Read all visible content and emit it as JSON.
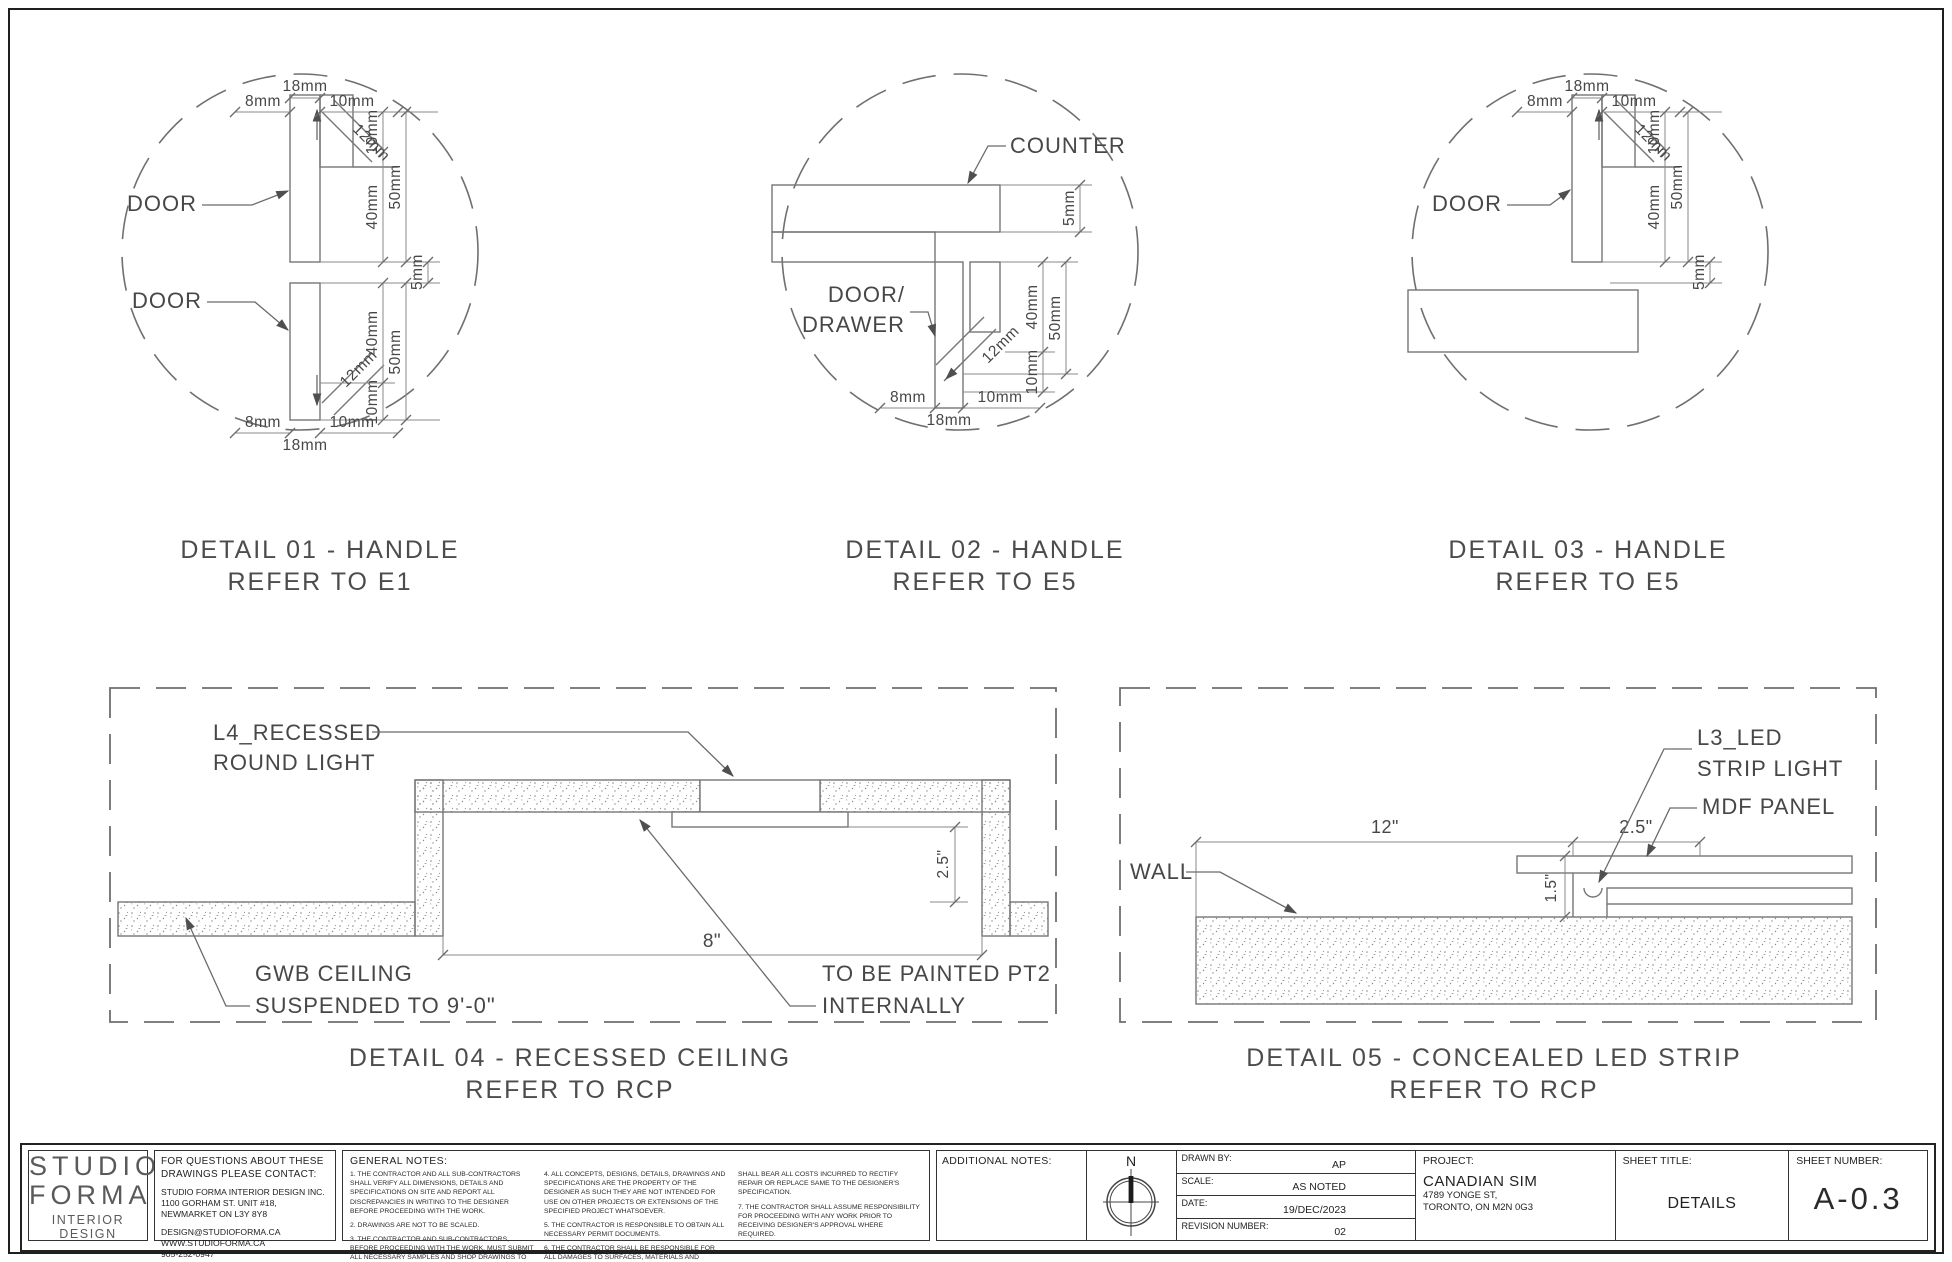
{
  "details": {
    "d01": {
      "title": "DETAIL 01 - HANDLE",
      "subtitle": "REFER TO E1",
      "labels": {
        "door_top": "DOOR",
        "door_bottom": "DOOR"
      },
      "dims": {
        "top": [
          "8mm",
          "18mm",
          "10mm"
        ],
        "bottom": [
          "8mm",
          "18mm",
          "10mm"
        ],
        "diag_top": "12mm",
        "diag_bottom": "12mm",
        "stack_top": [
          "10mm",
          "40mm",
          "50mm",
          "5mm"
        ],
        "stack_bottom": [
          "40mm",
          "50mm",
          "10mm"
        ]
      }
    },
    "d02": {
      "title": "DETAIL 02 - HANDLE",
      "subtitle": "REFER TO E5",
      "labels": {
        "counter": "COUNTER",
        "door_line1": "DOOR/",
        "door_line2": "DRAWER"
      },
      "dims": {
        "bottom": [
          "8mm",
          "18mm",
          "10mm"
        ],
        "diag": "12mm",
        "right": [
          "5mm",
          "40mm",
          "50mm",
          "10mm"
        ]
      }
    },
    "d03": {
      "title": "DETAIL 03 - HANDLE",
      "subtitle": "REFER TO E5",
      "labels": {
        "door": "DOOR"
      },
      "dims": {
        "top": [
          "8mm",
          "18mm",
          "10mm"
        ],
        "diag": "12mm",
        "stack": [
          "10mm",
          "40mm",
          "50mm",
          "5mm"
        ]
      }
    },
    "d04": {
      "title": "DETAIL 04 - RECESSED CEILING",
      "subtitle": "REFER TO RCP",
      "labels": {
        "light_1": "L4_RECESSED",
        "light_2": "ROUND LIGHT",
        "gwb_1": "GWB CEILING",
        "gwb_2": "SUSPENDED TO 9'-0\"",
        "paint_1": "TO BE PAINTED PT2",
        "paint_2": "INTERNALLY"
      },
      "dims": {
        "width": "8\"",
        "depth": "2.5\""
      }
    },
    "d05": {
      "title": "DETAIL 05 - CONCEALED LED STRIP",
      "subtitle": "REFER TO RCP",
      "labels": {
        "led_1": "L3_LED",
        "led_2": "STRIP LIGHT",
        "mdf": "MDF PANEL",
        "wall": "WALL"
      },
      "dims": {
        "run": "12\"",
        "panel": "2.5\"",
        "pocket": "1.5\""
      }
    }
  },
  "titleblock": {
    "logo": {
      "line1": "STUDIO",
      "line2": "FORMA",
      "line3": "INTERIOR DESIGN"
    },
    "contact": {
      "heading1": "FOR QUESTIONS ABOUT THESE",
      "heading2": "DRAWINGS PLEASE CONTACT:",
      "company": "STUDIO FORMA INTERIOR DESIGN INC.",
      "address1": "1100 GORHAM ST. UNIT #18,",
      "address2": "NEWMARKET ON L3Y 8Y8",
      "email": "DESIGN@STUDIOFORMA.CA",
      "website": "WWW.STUDIOFORMA.CA",
      "phone": "905-252-0947"
    },
    "general_notes": {
      "heading": "GENERAL NOTES:",
      "col1": [
        "1. THE CONTRACTOR AND ALL SUB-CONTRACTORS SHALL VERIFY ALL DIMENSIONS, DETAILS AND SPECIFICATIONS ON SITE AND REPORT ALL DISCREPANCIES IN WRITING TO THE DESIGNER BEFORE PROCEEDING WITH THE WORK.",
        "2. DRAWINGS ARE NOT TO BE SCALED.",
        "3. THE CONTRACTOR AND SUB-CONTRACTORS, BEFORE PROCEEDING WITH THE WORK, MUST SUBMIT ALL NECESSARY SAMPLES AND SHOP DRAWINGS TO THE DESIGNER FOR APPROVAL."
      ],
      "col2": [
        "4. ALL CONCEPTS, DESIGNS, DETAILS, DRAWINGS AND SPECIFICATIONS ARE THE PROPERTY OF THE DESIGNER AS SUCH THEY ARE NOT INTENDED FOR USE ON OTHER PROJECTS OR EXTENSIONS OF THE SPECIFIED PROJECT WHATSOEVER.",
        "5. THE CONTRACTOR IS RESPONSIBLE TO OBTAIN ALL NECESSARY PERMIT DOCUMENTS.",
        "6. THE CONTRACTOR SHALL BE RESPONSIBLE FOR ALL DAMAGES TO SURFACES, MATERIALS AND FINISHES AND"
      ],
      "col3": [
        "SHALL BEAR ALL COSTS INCURRED TO RECTIFY REPAIR OR REPLACE SAME TO THE DESIGNER'S SPECIFICATION.",
        "7. THE CONTRACTOR SHALL ASSUME RESPONSIBILITY FOR PROCEEDING WITH ANY WORK PRIOR TO RECEIVING DESIGNER'S APPROVAL WHERE REQUIRED."
      ]
    },
    "additional_notes_label": "ADDITIONAL NOTES:",
    "north_label": "N",
    "fields": [
      {
        "label": "DRAWN BY:",
        "value": "AP"
      },
      {
        "label": "SCALE:",
        "value": "AS NOTED"
      },
      {
        "label": "DATE:",
        "value": "19/DEC/2023"
      },
      {
        "label": "REVISION NUMBER:",
        "value": "02"
      }
    ],
    "project": {
      "label": "PROJECT:",
      "name": "CANADIAN SIM",
      "address1": "4789 YONGE ST,",
      "address2": "TORONTO, ON M2N 0G3"
    },
    "sheet_title": {
      "label": "SHEET TITLE:",
      "value": "DETAILS"
    },
    "sheet_number": {
      "label": "SHEET NUMBER:",
      "value": "A-0.3"
    }
  }
}
